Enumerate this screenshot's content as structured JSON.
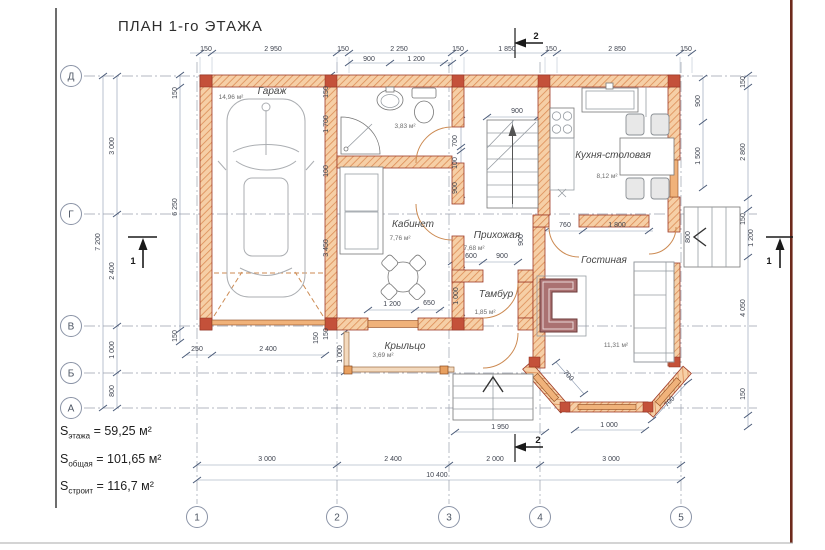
{
  "title": "ПЛАН 1-го ЭТАЖА",
  "summary": [
    {
      "prefix": "S",
      "sub": "этажа",
      "value": "= 59,25 м²"
    },
    {
      "prefix": "S",
      "sub": "общая",
      "value": "= 101,65 м²"
    },
    {
      "prefix": "S",
      "sub": "строит",
      "value": "= 116,7 м²"
    }
  ],
  "plan": {
    "rooms": [
      {
        "name": "Гараж",
        "area": "14,96 м²",
        "nx": 272,
        "ny": 94,
        "ax": 231,
        "ay": 99
      },
      {
        "name": "Кабинет",
        "area": "7,76 м²",
        "nx": 413,
        "ny": 227,
        "ax": 400,
        "ay": 240
      },
      {
        "name": "",
        "area": "3,83 м²",
        "nx": 0,
        "ny": 0,
        "ax": 405,
        "ay": 128
      },
      {
        "name": "Прихожая",
        "area": "7,68 м²",
        "nx": 497,
        "ny": 238,
        "ax": 474,
        "ay": 250
      },
      {
        "name": "Кухня-столовая",
        "area": "8,12 м²",
        "nx": 613,
        "ny": 158,
        "ax": 607,
        "ay": 178
      },
      {
        "name": "Гостиная",
        "area": "11,31 м²",
        "nx": 604,
        "ny": 263,
        "ax": 616,
        "ay": 347
      },
      {
        "name": "Тамбур",
        "area": "1,85 м²",
        "nx": 496,
        "ny": 297,
        "ax": 485,
        "ay": 314
      },
      {
        "name": "Крыльцо",
        "area": "3,69 м²",
        "nx": 405,
        "ny": 349,
        "ax": 383,
        "ay": 357
      }
    ],
    "axes": {
      "left": [
        [
          "Д",
          71,
          76
        ],
        [
          "Г",
          71,
          214
        ],
        [
          "В",
          71,
          326
        ],
        [
          "Б",
          71,
          373
        ],
        [
          "А",
          71,
          408
        ]
      ],
      "bottom": [
        [
          "1",
          197,
          517
        ],
        [
          "2",
          337,
          517
        ],
        [
          "3",
          449,
          517
        ],
        [
          "4",
          540,
          517
        ],
        [
          "5",
          681,
          517
        ]
      ]
    },
    "sections": [
      [
        "2",
        536,
        39
      ],
      [
        "2",
        538,
        443
      ],
      [
        "1",
        133,
        264
      ],
      [
        "1",
        769,
        264
      ]
    ],
    "dims": [
      [
        "150",
        206,
        51,
        0
      ],
      [
        "2 950",
        273,
        51,
        0
      ],
      [
        "150",
        343,
        51,
        0
      ],
      [
        "2 250",
        399,
        51,
        0
      ],
      [
        "150",
        458,
        51,
        0
      ],
      [
        "1 850",
        507,
        51,
        0
      ],
      [
        "150",
        551,
        51,
        0
      ],
      [
        "2 850",
        617,
        51,
        0
      ],
      [
        "150",
        686,
        51,
        0
      ],
      [
        "900",
        369,
        61,
        0
      ],
      [
        "1 200",
        416,
        61,
        0
      ],
      [
        "7 200",
        100,
        242,
        -90
      ],
      [
        "3 000",
        114,
        146,
        -90
      ],
      [
        "2 400",
        114,
        271,
        -90
      ],
      [
        "1 000",
        114,
        350,
        -90
      ],
      [
        "800",
        114,
        391,
        -90
      ],
      [
        "150",
        177,
        93,
        -90
      ],
      [
        "6 250",
        177,
        207,
        -90
      ],
      [
        "150",
        177,
        336,
        -90
      ],
      [
        "900",
        700,
        101,
        -90
      ],
      [
        "1 500",
        700,
        156,
        -90
      ],
      [
        "150",
        745,
        82,
        -90
      ],
      [
        "2 860",
        745,
        152,
        -90
      ],
      [
        "150",
        745,
        219,
        -90
      ],
      [
        "1 200",
        753,
        238,
        -90
      ],
      [
        "4 050",
        745,
        308,
        -90
      ],
      [
        "150",
        745,
        394,
        -90
      ],
      [
        "800",
        690,
        237,
        -90
      ],
      [
        "3 000",
        267,
        461,
        0
      ],
      [
        "2 400",
        393,
        461,
        0
      ],
      [
        "2 000",
        495,
        461,
        0
      ],
      [
        "3 000",
        611,
        461,
        0
      ],
      [
        "10 400",
        437,
        477,
        0
      ],
      [
        "1 950",
        500,
        429,
        0
      ],
      [
        "150",
        328,
        92,
        -90
      ],
      [
        "1 700",
        328,
        124,
        -90
      ],
      [
        "100",
        328,
        171,
        -90
      ],
      [
        "3 450",
        328,
        248,
        -90
      ],
      [
        "150",
        328,
        334,
        -90
      ],
      [
        "250",
        197,
        351,
        0
      ],
      [
        "2 400",
        268,
        351,
        0
      ],
      [
        "150",
        318,
        338,
        -90
      ],
      [
        "1 000",
        342,
        354,
        -90
      ],
      [
        "1 200",
        392,
        306,
        0
      ],
      [
        "650",
        429,
        305,
        0
      ],
      [
        "1 000",
        458,
        296,
        -90
      ],
      [
        "900",
        517,
        113,
        0
      ],
      [
        "700",
        457,
        141,
        -90
      ],
      [
        "100",
        457,
        163,
        -90
      ],
      [
        "900",
        457,
        188,
        -90
      ],
      [
        "600",
        471,
        258,
        0
      ],
      [
        "900",
        502,
        258,
        0
      ],
      [
        "900",
        523,
        240,
        -90
      ],
      [
        "760",
        565,
        227,
        0
      ],
      [
        "1 800",
        617,
        227,
        0
      ],
      [
        "700",
        567,
        377,
        47
      ],
      [
        "700",
        671,
        403,
        -47
      ],
      [
        "1 000",
        609,
        427,
        0
      ]
    ]
  },
  "colors": {
    "wall_outline": "#9e3a28",
    "wall_fill": "#f6cfa6",
    "wall_hatch": "#dc8c55",
    "window_fill": "#f0b27a",
    "door_arc": "#cc8a52",
    "fireplace": "#aa7171",
    "dimension_line": "#8b9ab0",
    "grid_line": "#9aa0ad",
    "frame_right": "#6e2a1c"
  }
}
